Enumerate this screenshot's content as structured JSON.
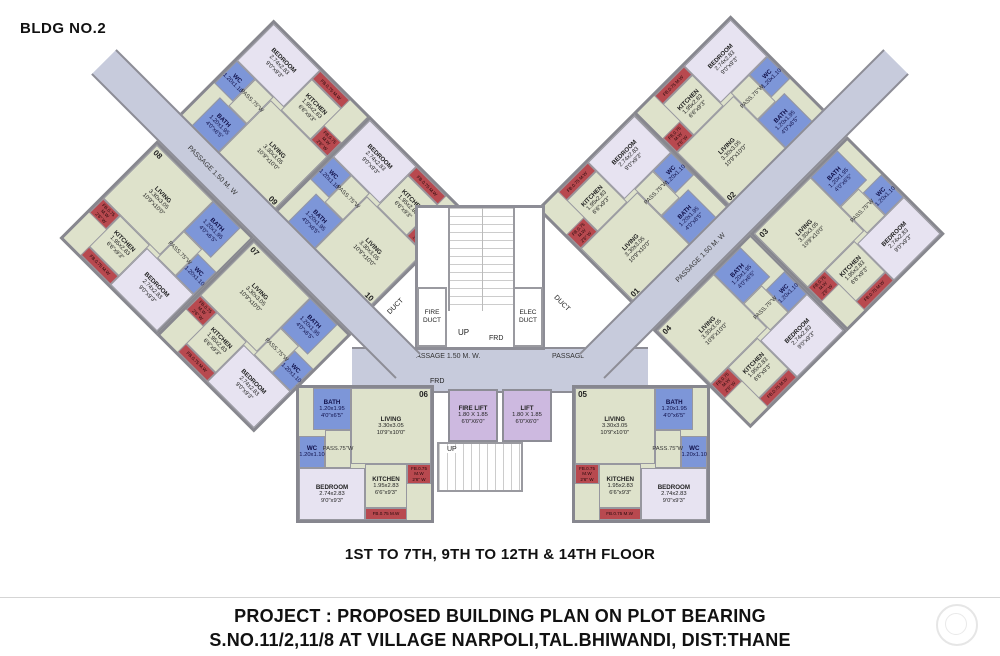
{
  "header": {
    "building": "BLDG NO.2"
  },
  "captions": {
    "floors": "1ST TO 7TH, 9TH TO 12TH & 14TH FLOOR",
    "project_line1": "PROJECT : PROPOSED BUILDING PLAN ON PLOT BEARING",
    "project_line2": "S.NO.11/2,11/8 AT VILLAGE NARPOLI,TAL.BHIWANDI, DIST:THANE"
  },
  "core": {
    "up": "UP",
    "frd": "FRD",
    "fire_duct": "FIRE DUCT",
    "elec_duct": "ELEC DUCT",
    "duct": "DUCT",
    "passage_main": "PASSAGE 1.50 M. W.",
    "passage_wing": "PASSAGE 1.50 M. W",
    "fire_lift": {
      "name": "FIRE LIFT",
      "dim_m": "1.80 X 1.85",
      "dim_ft": "6'0\"X6'0\""
    },
    "lift": {
      "name": "LIFT",
      "dim_m": "1.80 X 1.85",
      "dim_ft": "6'0\"X6'0\""
    }
  },
  "rooms": {
    "living": {
      "name": "LIVING",
      "dim_m": "3.30x3.05",
      "dim_ft": "10'9\"x10'0\""
    },
    "kitchen": {
      "name": "KITCHEN",
      "dim_m": "1.95x2.83",
      "dim_ft": "6'6\"x9'3\""
    },
    "bedroom": {
      "name": "BEDROOM",
      "dim_m": "2.74x2.83",
      "dim_ft": "9'0\"x9'3\""
    },
    "bath": {
      "name": "BATH",
      "dim_m": "1.20x1.95",
      "dim_ft": "4'0\"x6'5\""
    },
    "wc": {
      "name": "WC",
      "dim_m": "1.20x1.10",
      "dim_ft": "4'0\"x3'8\""
    },
    "fb": {
      "name": "FB.0.75 M.W",
      "dim": "2'6\" W"
    },
    "pass": {
      "name": "PASS.75\"W"
    }
  },
  "units": {
    "u01": "01",
    "u02": "02",
    "u03": "03",
    "u04": "04",
    "u05": "05",
    "u06": "06",
    "u07": "07",
    "u08": "08",
    "u09": "09",
    "u10": "10"
  },
  "colors": {
    "room_green": "#dee2cb",
    "bedroom_lavender": "#e7e3f1",
    "bath_blue": "#7d96d8",
    "fb_red": "#b8494f",
    "passage_gray": "#c7cbdc",
    "lift_violet": "#cdb9e0",
    "wall": "#87878f"
  }
}
